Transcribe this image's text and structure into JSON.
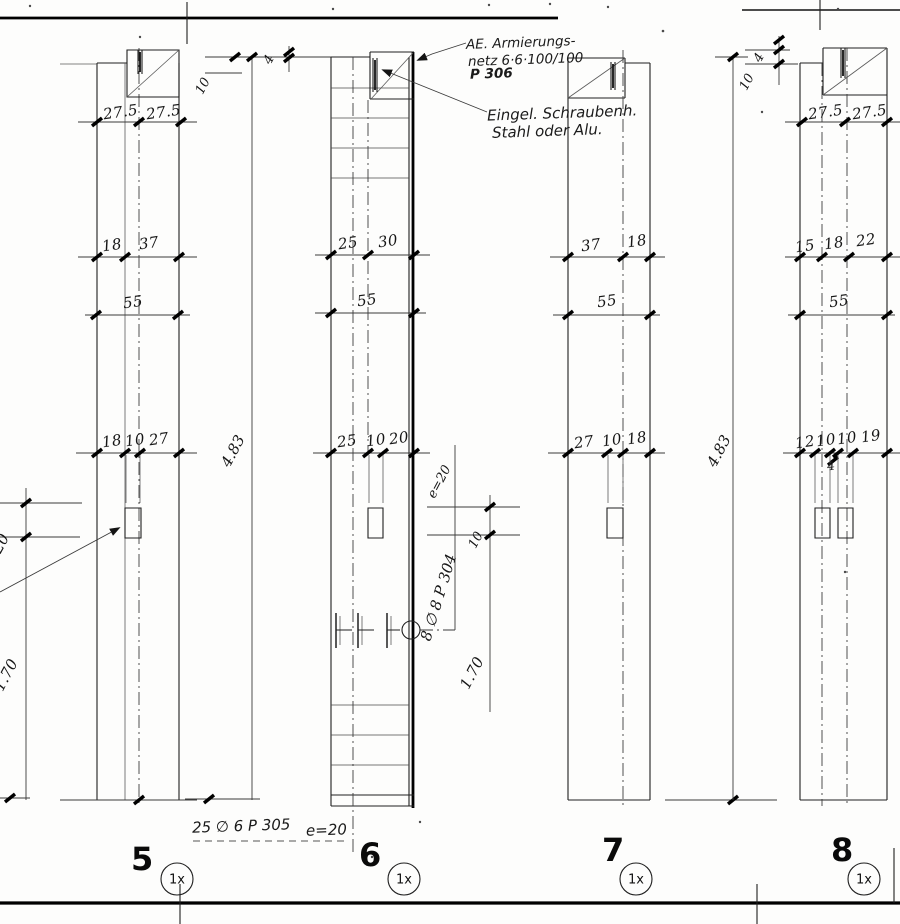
{
  "panels": [
    {
      "id": "5",
      "multiplier": "1x",
      "dims_top": [
        "27.5",
        "27.5"
      ],
      "dims_upper": [
        "18",
        "37"
      ],
      "dims_mid": [
        "55"
      ],
      "dims_lower": [
        "18",
        "10",
        "27"
      ]
    },
    {
      "id": "6",
      "multiplier": "1x",
      "dims_upper": [
        "25",
        "30"
      ],
      "dims_mid": [
        "55"
      ],
      "dims_lower": [
        "25",
        "10",
        "20"
      ]
    },
    {
      "id": "7",
      "multiplier": "1x",
      "dims_upper": [
        "37",
        "18"
      ],
      "dims_mid": [
        "55"
      ],
      "dims_lower": [
        "27",
        "10",
        "18"
      ]
    },
    {
      "id": "8",
      "multiplier": "1x",
      "dims_top": [
        "27.5",
        "27.5"
      ],
      "dims_upper": [
        "15",
        "18",
        "22"
      ],
      "dims_mid": [
        "55"
      ],
      "dims_lower": [
        "12",
        "10",
        "10",
        "19"
      ],
      "dims_gap": "4"
    }
  ],
  "shared_dims": {
    "overall_height": "4.83",
    "bottom_zone": "1.70",
    "top_left_offset": "20",
    "edge_offset_10": "10",
    "edge_offset_4": "4",
    "anchor_offset_10": "10"
  },
  "notes": {
    "mesh_line1": "AE. Armierungs-",
    "mesh_line2": "netz 6·6·100/100",
    "mesh_line3": "P 306",
    "insert_line1": "Eingel. Schraubenh.",
    "insert_line2": "Stahl oder Alu.",
    "side_bars": "8 ∅ 8 P 304",
    "side_bars_spacing": "e=20",
    "bottom_bars": "25 ∅ 6 P 305",
    "bottom_bars_spacing": "e=20"
  }
}
